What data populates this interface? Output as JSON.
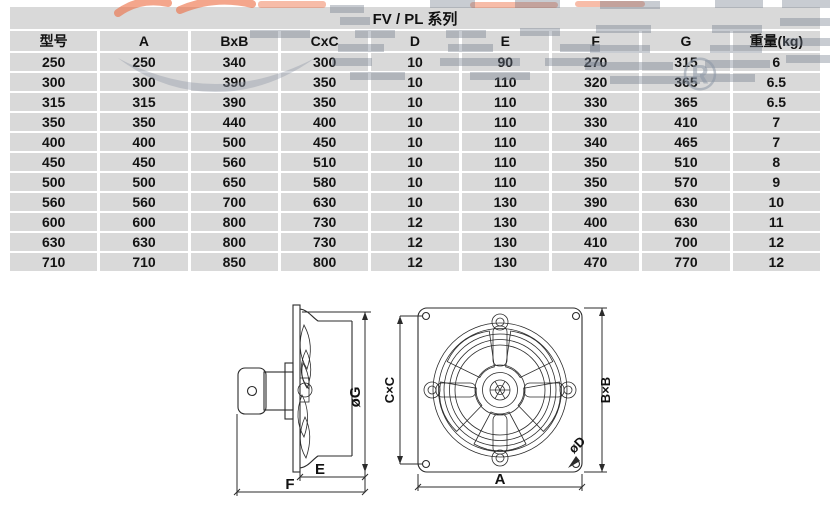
{
  "table": {
    "title": "FV / PL 系列",
    "columns": [
      "型号",
      "A",
      "BxB",
      "CxC",
      "D",
      "E",
      "F",
      "G",
      "重量(kg)"
    ],
    "rows": [
      [
        "250",
        "250",
        "340",
        "300",
        "10",
        "90",
        "270",
        "315",
        "6"
      ],
      [
        "300",
        "300",
        "390",
        "350",
        "10",
        "110",
        "320",
        "365",
        "6.5"
      ],
      [
        "315",
        "315",
        "390",
        "350",
        "10",
        "110",
        "330",
        "365",
        "6.5"
      ],
      [
        "350",
        "350",
        "440",
        "400",
        "10",
        "110",
        "330",
        "410",
        "7"
      ],
      [
        "400",
        "400",
        "500",
        "450",
        "10",
        "110",
        "340",
        "465",
        "7"
      ],
      [
        "450",
        "450",
        "560",
        "510",
        "10",
        "110",
        "350",
        "510",
        "8"
      ],
      [
        "500",
        "500",
        "650",
        "580",
        "10",
        "110",
        "350",
        "570",
        "9"
      ],
      [
        "560",
        "560",
        "700",
        "630",
        "10",
        "130",
        "390",
        "630",
        "10"
      ],
      [
        "600",
        "600",
        "800",
        "730",
        "12",
        "130",
        "400",
        "630",
        "11"
      ],
      [
        "630",
        "630",
        "800",
        "730",
        "12",
        "130",
        "410",
        "700",
        "12"
      ],
      [
        "710",
        "710",
        "850",
        "800",
        "12",
        "130",
        "470",
        "770",
        "12"
      ]
    ]
  },
  "watermark": {
    "registered_mark": "®"
  },
  "drawing": {
    "side_view": {
      "g_label": "øG",
      "e_label": "E",
      "f_label": "F"
    },
    "front_view": {
      "cc_label": "C×C",
      "bb_label": "B×B",
      "a_label": "A",
      "d_label": "øD"
    }
  },
  "colors": {
    "cell_bg": "#d9d9d9",
    "watermark_gray": "#8d97a5",
    "watermark_orange": "#ed6b3f",
    "line": "#2b2b2b"
  }
}
